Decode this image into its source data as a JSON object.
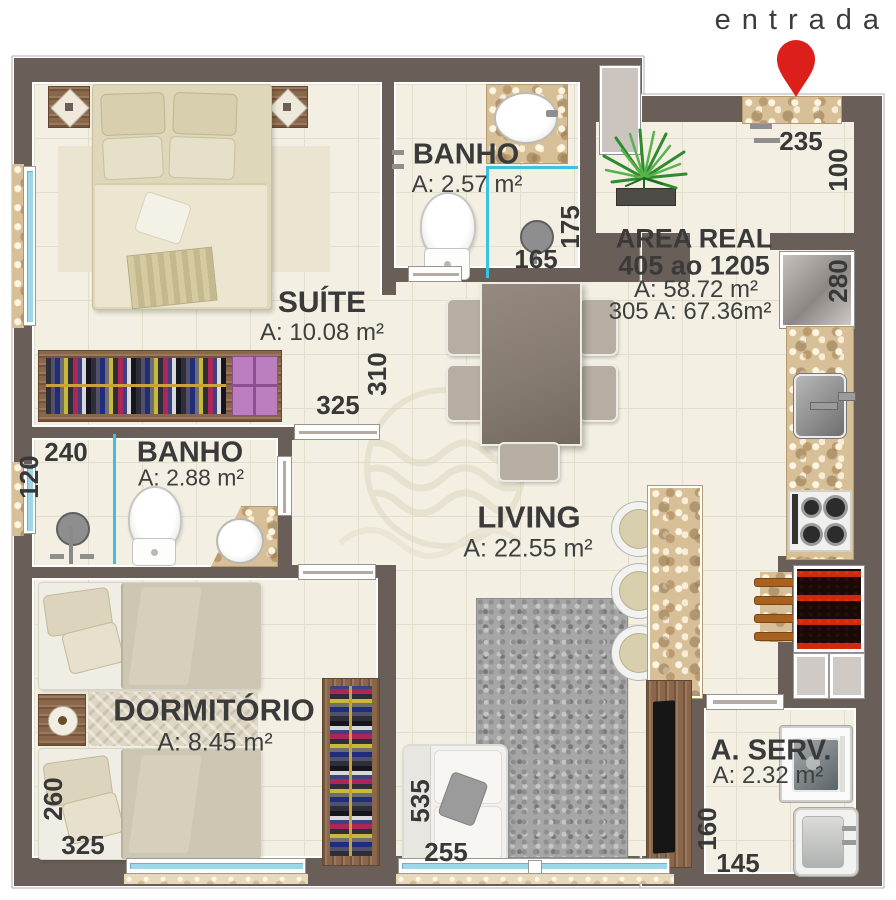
{
  "page": {
    "entrada": "entrada"
  },
  "rooms": {
    "suite": {
      "name": "SUÍTE",
      "area": "A: 10.08 m²"
    },
    "banho_suite": {
      "name": "BANHO",
      "area": "A: 2.57 m²"
    },
    "banho_social": {
      "name": "BANHO",
      "area": "A: 2.88 m²"
    },
    "living": {
      "name": "LIVING",
      "area": "A: 22.55 m²"
    },
    "dormitorio": {
      "name": "DORMITÓRIO",
      "area": "A: 8.45 m²"
    },
    "area_servico": {
      "name": "A. SERV.",
      "area": "A: 2.32 m²"
    }
  },
  "area_real": {
    "title": "AREA REAL",
    "range": "405 ao 1205",
    "area": "A: 58.72 m²",
    "area_alt": "305 A: 67.36m²"
  },
  "dims": {
    "hall_w": "235",
    "hall_d": "100",
    "banho_suite_w": "165",
    "banho_suite_d": "175",
    "suite_w": "325",
    "suite_d": "310",
    "kitchen_d": "280",
    "banho_social_w": "240",
    "banho_social_d": "120",
    "dorm_w": "325",
    "dorm_d": "260",
    "living_w": "255",
    "living_d": "535",
    "aserv_w": "145",
    "aserv_d": "160"
  },
  "colors": {
    "wall": "#6a5e58",
    "floor": "#f3f0e3",
    "granite": "#d7bf97",
    "window_glass": "#9fd6e8",
    "shower_glass": "#3cc1e0",
    "entry_pin": "#dd1f1c",
    "label_text": "#3a3a3a",
    "wood": "#8a674a",
    "rug": "#a6a6a6",
    "plant": "#2e8b2e"
  }
}
